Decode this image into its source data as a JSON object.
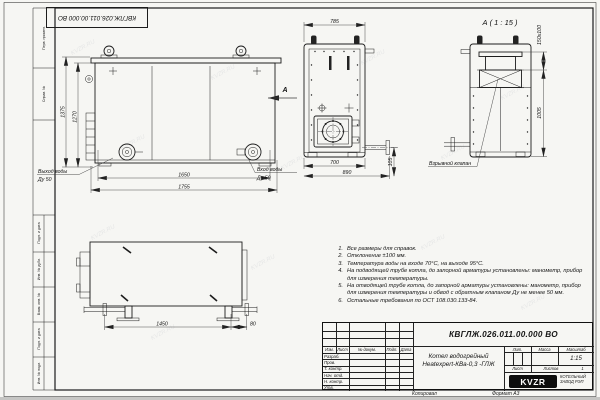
{
  "watermark": {
    "text": "KVZR.RU"
  },
  "stamp_top": {
    "doc_number": "КВГЛЖ.026.011.00.000 ВО"
  },
  "frame": {
    "left_labels": [
      "Перв. примен.",
      "Справ. №",
      "Подп. и дата",
      "Инв. № дубл.",
      "Взам. инв. №",
      "Подп. и дата",
      "Инв. № подл."
    ]
  },
  "views": {
    "front": {
      "dim_width_inner": "1650",
      "dim_width_outer": "1755",
      "dim_height_outer": "1375",
      "dim_height_inner": "1270",
      "outlet_label": "Выход воды",
      "outlet_dn": "Ду 50",
      "inlet_label": "Вход воды",
      "inlet_dn": "Ду 50",
      "view_arrow_label": "А"
    },
    "rear": {
      "dim_top": "785",
      "dim_bottom_inner": "700",
      "dim_bottom_outer": "890",
      "dim_pipe": "105"
    },
    "detail_a": {
      "title": "А ( 1 : 15 )",
      "dim_flue": "150х100",
      "dim_height": "1005",
      "valve_label": "Взрывной клапан"
    },
    "side": {
      "dim_length": "1450",
      "dim_offset": "80"
    }
  },
  "notes": {
    "items": [
      {
        "num": "1.",
        "text": "Все размеры для справок."
      },
      {
        "num": "2.",
        "text": "Отклонение ±100 мм."
      },
      {
        "num": "3.",
        "text": "Температура воды на входе 70°С, на выходе 95°С."
      },
      {
        "num": "4.",
        "text": "На подводящей трубе котла, до запорной арматуры установлены: манометр, прибор для измерения температуры."
      },
      {
        "num": "5.",
        "text": "На отводящей трубе котла, до запорной арматуры установлены: манометр, прибор для измерения температуры и обвод с обратным клапаном Ду не менее 50 мм."
      },
      {
        "num": "6.",
        "text": "Остальные требования по ОСТ 108.030.133-84."
      }
    ]
  },
  "title_block": {
    "doc_number": "КВГЛЖ.026.011.00.000 ВО",
    "product_name_line1": "Котел водогрейный",
    "product_name_line2": "Heatexpert-КВа-0,3 -ГЛЖ",
    "col_izm": "Изм.",
    "col_list": "Лист",
    "col_doc": "№ докум.",
    "col_podp": "Подп.",
    "col_data": "Дата",
    "row_razrab": "Разраб.",
    "row_prov": "Пров.",
    "row_tkontr": "Т. контр.",
    "row_nachotd": "Нач. отд.",
    "row_nkontr": "Н. контр.",
    "row_utv": "Утв.",
    "lit_label": "Лит.",
    "mass_label": "Масса",
    "scale_label": "Масштаб",
    "scale_value": "1:15",
    "sheet_label": "Лист",
    "sheets_label": "Листов",
    "sheets_value": "1",
    "logo_text": "KVZR",
    "company_line1": "КОТЕЛЬНЫЙ",
    "company_line2": "ЗАВОД РЭП"
  },
  "footer": {
    "copied": "Копировал",
    "format": "Формат А3"
  }
}
